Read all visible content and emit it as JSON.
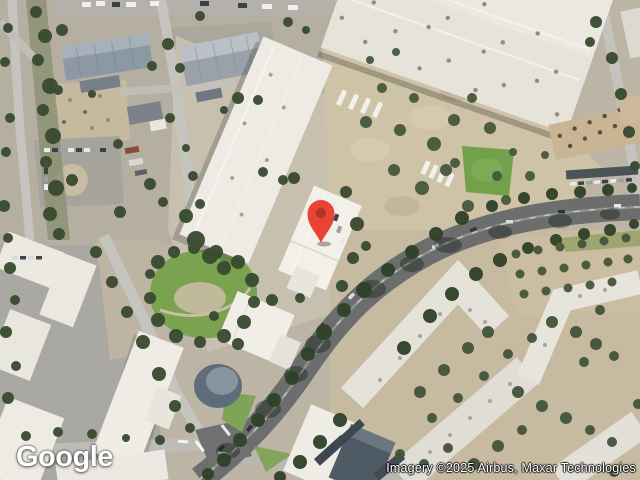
{
  "map": {
    "logo_text": "Google",
    "attribution_text": "Imagery ©2025 Airbus, Maxar Technologies"
  },
  "marker": {
    "icon": "location-pin-icon",
    "color": "#EA4335",
    "dot_color": "#B03527"
  },
  "palette": {
    "asphalt_major_road": "#6B6E6D",
    "minor_road": "#C5C4BE",
    "tree_green": "#384A30",
    "grass_green": "#7BA24F",
    "white_roof": "#EDEBE3",
    "blue_gray_roof": "#8C98A3",
    "dirt_tan": "#CFC3A7"
  }
}
